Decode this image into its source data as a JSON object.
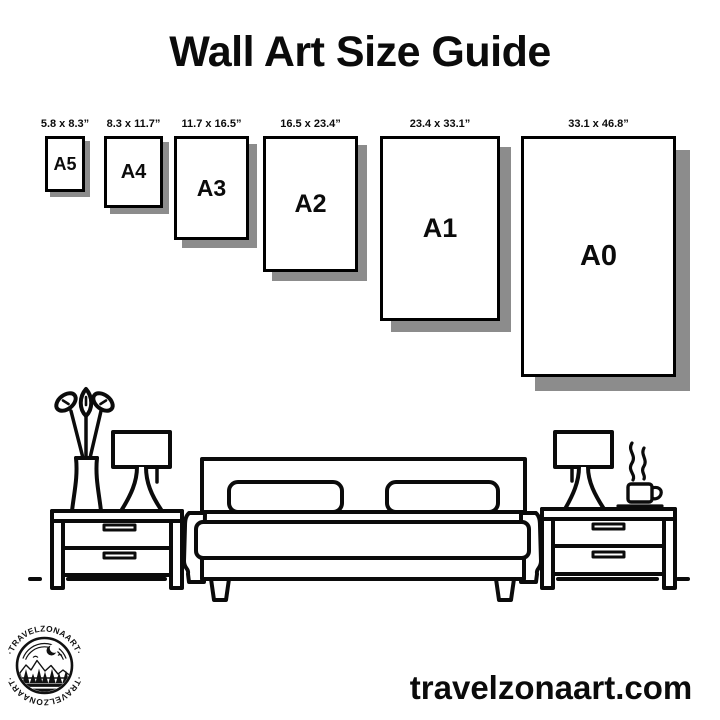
{
  "title": "Wall Art Size Guide",
  "size_guide": {
    "frames": [
      {
        "label": "A5",
        "dimensions": "5.8 x 8.3”"
      },
      {
        "label": "A4",
        "dimensions": "8.3 x 11.7”"
      },
      {
        "label": "A3",
        "dimensions": "11.7 x 16.5”"
      },
      {
        "label": "A2",
        "dimensions": "16.5 x 23.4”"
      },
      {
        "label": "A1",
        "dimensions": "23.4 x 33.1”"
      },
      {
        "label": "A0",
        "dimensions": "33.1 x 46.8”"
      }
    ],
    "unit": "inches",
    "frame_border_color": "#000000",
    "shadow_color": "#8c8c8c"
  },
  "illustration": {
    "items": [
      "bed-icon",
      "pillow-icon",
      "nightstand-icon",
      "table-lamp-icon",
      "vase-flowers-icon",
      "coffee-cup-icon"
    ],
    "line_color": "#0b0b0b"
  },
  "logo": {
    "brand": "TRAVELZONAART",
    "ring_text_top": "·TRAVELZONAART·",
    "ring_text_bottom": "·TRAVELZONAART·"
  },
  "footer": {
    "website": "travelzonaart.com"
  }
}
